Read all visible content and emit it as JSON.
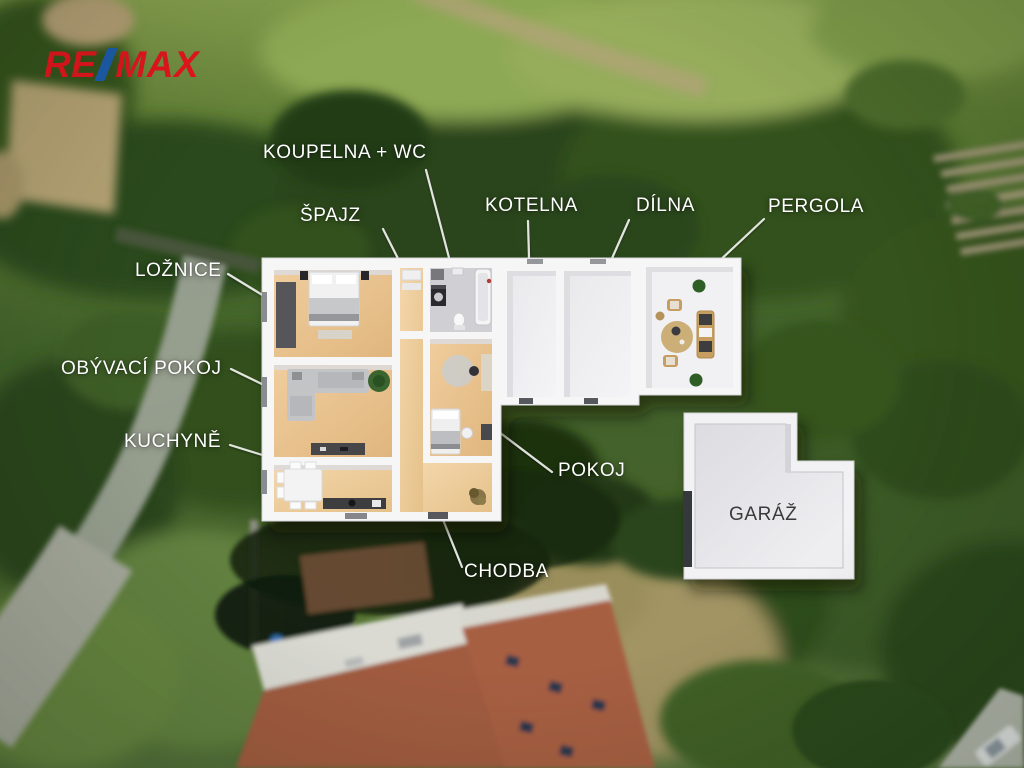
{
  "brand": {
    "re": "RE",
    "max": "MAX"
  },
  "annotations": {
    "koupelna": "KOUPELNA + WC",
    "spajz": "ŠPAJZ",
    "kotelna": "KOTELNA",
    "dilna": "DÍLNA",
    "pergola": "PERGOLA",
    "loznice": "LOŽNICE",
    "obyvaci": "OBÝVACÍ POKOJ",
    "kuchyne": "KUCHYNĚ",
    "pokoj": "POKOJ",
    "chodba": "CHODBA",
    "garaz": "GARÁŽ"
  },
  "colors": {
    "label_text": "#ffffff",
    "garage_label_text": "#3a3a3a",
    "brand_red": "#e3151d",
    "brand_blue": "#1c5cab",
    "leader_line": "#eeeeea",
    "wood_floor": "#e9c democratic"
  }
}
